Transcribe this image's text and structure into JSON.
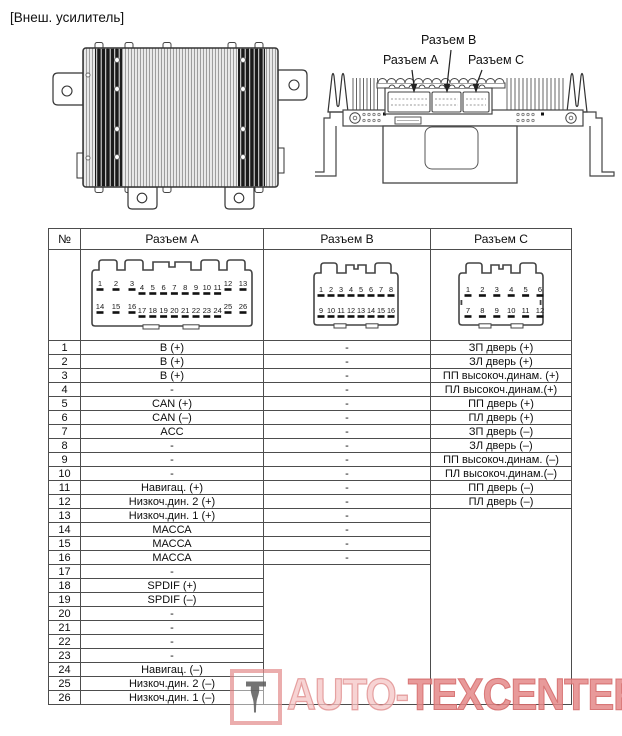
{
  "page": {
    "label": "[Внеш. усилитель]"
  },
  "amp_diagram": {
    "connector_a": "Разъем A",
    "connector_b": "Разъем B",
    "connector_c": "Разъем C"
  },
  "table": {
    "headers": {
      "num": "№",
      "a": "Разъем A",
      "b": "Разъем B",
      "c": "Разъем C"
    },
    "connector_pins": {
      "a": {
        "top": [
          "1",
          "2",
          "3",
          "4",
          "5",
          "6",
          "7",
          "8",
          "9",
          "10",
          "11",
          "12",
          "13"
        ],
        "bottom": [
          "14",
          "15",
          "16",
          "17",
          "18",
          "19",
          "20",
          "21",
          "22",
          "23",
          "24",
          "25",
          "26"
        ]
      },
      "b": {
        "top": [
          "1",
          "2",
          "3",
          "4",
          "5",
          "6",
          "7",
          "8"
        ],
        "bottom": [
          "9",
          "10",
          "11",
          "12",
          "13",
          "14",
          "15",
          "16"
        ]
      },
      "c": {
        "top": [
          "1",
          "2",
          "3",
          "4",
          "5",
          "6"
        ],
        "bottom": [
          "7",
          "8",
          "9",
          "10",
          "11",
          "12"
        ]
      }
    },
    "rows": [
      {
        "n": "1",
        "a": "B (+)",
        "b": "-",
        "c": "ЗП дверь (+)"
      },
      {
        "n": "2",
        "a": "B (+)",
        "b": "-",
        "c": "ЗЛ дверь (+)"
      },
      {
        "n": "3",
        "a": "B (+)",
        "b": "-",
        "c": "ПП высокоч.динам. (+)"
      },
      {
        "n": "4",
        "a": "-",
        "b": "-",
        "c": "ПЛ высокоч.динам.(+)"
      },
      {
        "n": "5",
        "a": "CAN (+)",
        "b": "-",
        "c": "ПП дверь (+)"
      },
      {
        "n": "6",
        "a": "CAN (–)",
        "b": "-",
        "c": "ПЛ дверь (+)"
      },
      {
        "n": "7",
        "a": "ACC",
        "b": "-",
        "c": "ЗП дверь (–)"
      },
      {
        "n": "8",
        "a": "-",
        "b": "-",
        "c": "ЗЛ дверь (–)"
      },
      {
        "n": "9",
        "a": "-",
        "b": "-",
        "c": "ПП высокоч.динам. (–)"
      },
      {
        "n": "10",
        "a": "-",
        "b": "-",
        "c": "ПЛ высокоч.динам.(–)"
      },
      {
        "n": "11",
        "a": "Навигац. (+)",
        "b": "-",
        "c": "ПП дверь (–)"
      },
      {
        "n": "12",
        "a": "Низкоч.дин. 2 (+)",
        "b": "-",
        "c": "ПЛ дверь (–)"
      },
      {
        "n": "13",
        "a": "Низкоч.дин. 1 (+)",
        "b": "-",
        "c": null
      },
      {
        "n": "14",
        "a": "МАССА",
        "b": "-",
        "c": null
      },
      {
        "n": "15",
        "a": "МАССА",
        "b": "-",
        "c": null
      },
      {
        "n": "16",
        "a": "МАССА",
        "b": "-",
        "c": null
      },
      {
        "n": "17",
        "a": "-",
        "b": null,
        "c": null
      },
      {
        "n": "18",
        "a": "SPDIF (+)",
        "b": null,
        "c": null
      },
      {
        "n": "19",
        "a": "SPDIF (–)",
        "b": null,
        "c": null
      },
      {
        "n": "20",
        "a": "-",
        "b": null,
        "c": null
      },
      {
        "n": "21",
        "a": "-",
        "b": null,
        "c": null
      },
      {
        "n": "22",
        "a": "-",
        "b": null,
        "c": null
      },
      {
        "n": "23",
        "a": "-",
        "b": null,
        "c": null
      },
      {
        "n": "24",
        "a": "Навигац. (–)",
        "b": null,
        "c": null
      },
      {
        "n": "25",
        "a": "Низкоч.дин. 2 (–)",
        "b": null,
        "c": null
      },
      {
        "n": "26",
        "a": "Низкоч.дин. 1 (–)",
        "b": null,
        "c": null
      }
    ]
  },
  "watermark": {
    "part1": "AUTO-",
    "part2": "TEXCENTER.",
    "part3": "RU"
  },
  "colors": {
    "line": "#4d4d4d",
    "watermark_red": "#d85c5c"
  }
}
